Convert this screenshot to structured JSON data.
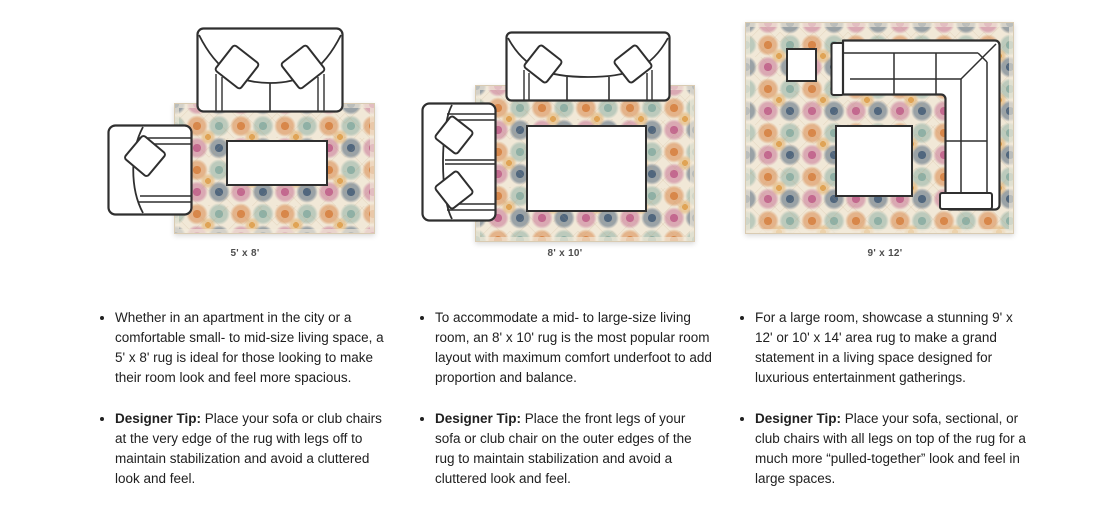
{
  "sections": [
    {
      "size_label": "5' x 8'",
      "description": "Whether in an apartment in the city or a comfortable small- to mid-size living space, a 5' x 8' rug is ideal for those looking to make their room look and feel more spacious.",
      "tip_label": "Designer Tip:",
      "tip_text": " Place your sofa or club chairs at the very edge of the rug with legs off to maintain stabilization and avoid a cluttered look and feel."
    },
    {
      "size_label": "8' x 10'",
      "description": "To accommodate a mid- to large-size living room, an 8' x 10' rug is the most popular room layout with maximum comfort underfoot to add proportion and balance.",
      "tip_label": "Designer Tip:",
      "tip_text": " Place the front legs of your sofa or club chair on the outer edges of the rug to maintain stabilization and avoid a cluttered look and feel."
    },
    {
      "size_label": "9' x 12'",
      "description": "For a large room, showcase a stunning 9' x 12' or 10' x 14' area rug to make a grand statement in a living space designed for luxurious entertainment gatherings.",
      "tip_label": "Designer Tip:",
      "tip_text": " Place your sofa, sectional, or club chairs with all legs on top of the rug for a much more “pulled-together” look and feel in large spaces."
    }
  ],
  "colors": {
    "text": "#202020",
    "label_text": "#4d4d4d",
    "furniture_outline": "#2f2f2f",
    "rug_background": "#f1e8d7",
    "rug_orange": "#d8874a",
    "rug_navy": "#51677e",
    "rug_teal": "#8fb0a5",
    "rug_pink": "#c3698f",
    "rug_gold": "#e0a455"
  }
}
